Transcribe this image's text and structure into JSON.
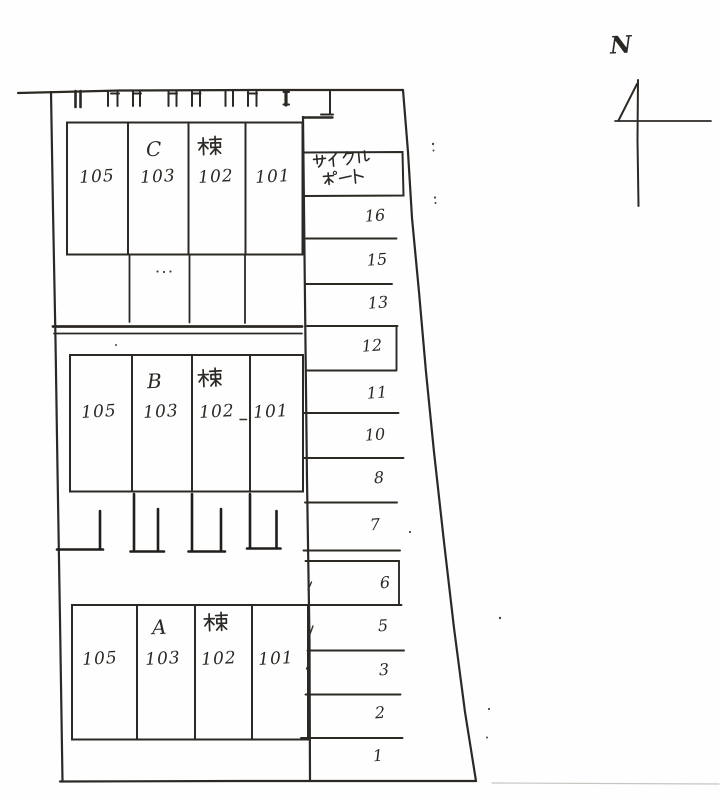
{
  "compass": {
    "label": "N"
  },
  "buildings": [
    {
      "letter": "C",
      "suffix": "棟",
      "units": [
        "105",
        "103",
        "102",
        "101"
      ]
    },
    {
      "letter": "B",
      "suffix": "棟",
      "units": [
        "105",
        "103",
        "102",
        "101"
      ]
    },
    {
      "letter": "A",
      "suffix": "棟",
      "units": [
        "105",
        "103",
        "102",
        "101"
      ]
    }
  ],
  "cycle_port": {
    "line1": "サイクル",
    "line2": "ポート"
  },
  "parking": {
    "stalls": [
      "16",
      "15",
      "13",
      "12",
      "11",
      "10",
      "8",
      "7",
      "6",
      "5",
      "3",
      "2",
      "1"
    ]
  },
  "colors": {
    "ink": "#2c2925",
    "paper": "#ffffff"
  }
}
